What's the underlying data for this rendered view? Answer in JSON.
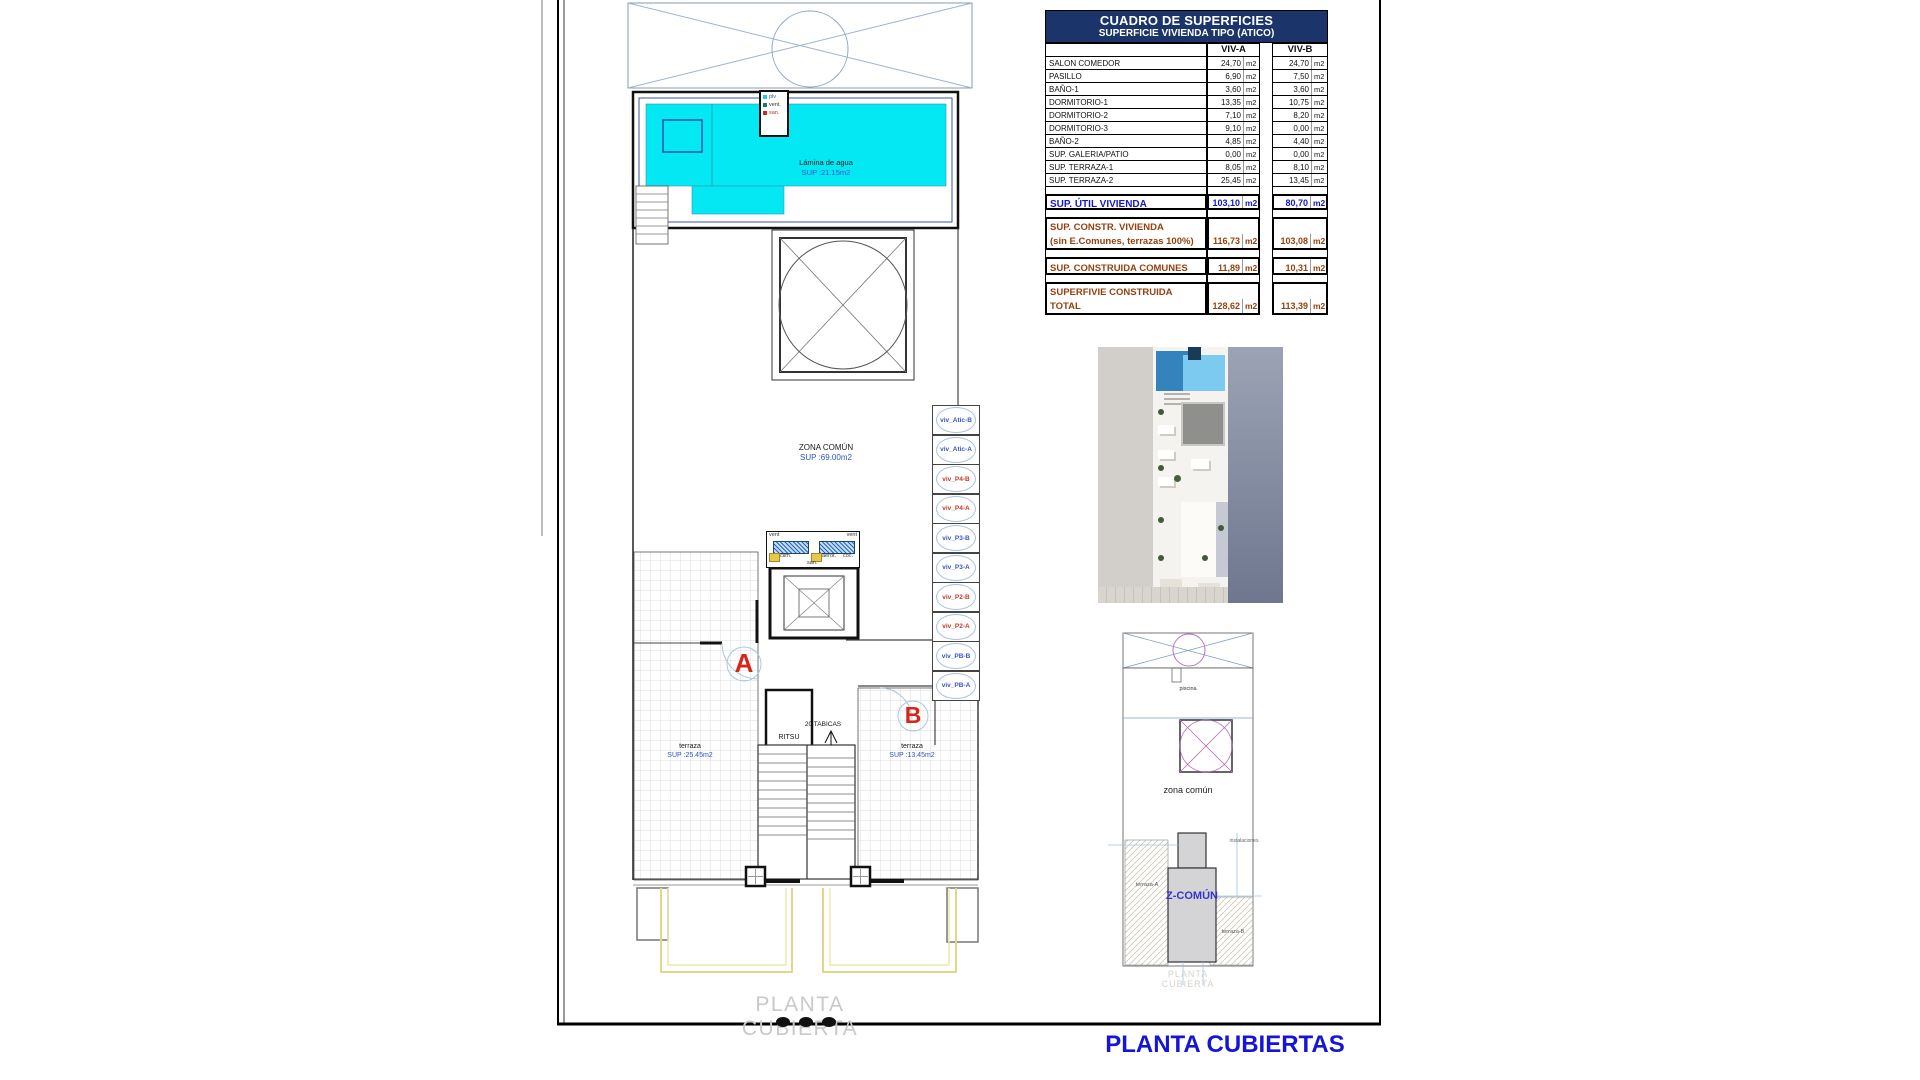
{
  "frame": {
    "sheet_caption": "PLANTA CUBIERTA",
    "title": "PLANTA CUBIERTAS"
  },
  "table": {
    "title": "CUADRO DE SUPERFICIES",
    "subtitle": "SUPERFICIE VIVIENDA TIPO  (ATICO)",
    "col_a": "VIV-A",
    "col_b": "VIV-B",
    "unit": "m2",
    "rows": [
      {
        "label": "SALON COMEDOR",
        "a": "24,70",
        "b": "24,70"
      },
      {
        "label": "PASILLO",
        "a": "6,90",
        "b": "7,50"
      },
      {
        "label": "BAÑO-1",
        "a": "3,60",
        "b": "3,60"
      },
      {
        "label": "DORMITORIO-1",
        "a": "13,35",
        "b": "10,75"
      },
      {
        "label": "DORMITORIO-2",
        "a": "7,10",
        "b": "8,20"
      },
      {
        "label": "DORMITORIO-3",
        "a": "9,10",
        "b": "0,00"
      },
      {
        "label": "BAÑO-2",
        "a": "4,85",
        "b": "4,40"
      },
      {
        "label": "SUP. GALERIA/PATIO",
        "a": "0,00",
        "b": "0,00"
      },
      {
        "label": "SUP. TERRAZA-1",
        "a": "8,05",
        "b": "8,10"
      },
      {
        "label": "SUP. TERRAZA-2",
        "a": "25,45",
        "b": "13,45"
      }
    ],
    "summary": [
      {
        "label": "SUP. ÚTIL VIVIENDA",
        "label2": "",
        "a": "103,10",
        "b": "80,70"
      },
      {
        "label": "SUP. CONSTR. VIVIENDA",
        "label2": "(sin E.Comunes, terrazas 100%)",
        "a": "116,73",
        "b": "103,08"
      },
      {
        "label": "SUP. CONSTRUIDA COMUNES",
        "label2": "",
        "a": "11,89",
        "b": "10,31"
      },
      {
        "label": "SUPERFIVIE CONSTRUIDA",
        "label2": "TOTAL",
        "a": "128,62",
        "b": "113,39"
      }
    ]
  },
  "plan": {
    "pool": {
      "name": "Lámina de agua",
      "area": "SUP :21.15m2"
    },
    "pool_legend": [
      {
        "label": "plv",
        "color": "#28c8e0",
        "text_color": "#2a55c8"
      },
      {
        "label": "vent.",
        "color": "#1b7a70",
        "text_color": "#333333"
      },
      {
        "label": "san.",
        "color": "#c03028",
        "text_color": "#c03028"
      }
    ],
    "zona_comun": {
      "name": "ZONA COMÚN",
      "area": "SUP :69.00m2"
    },
    "machine": {
      "vent_left": "vent",
      "vent_right": "vent",
      "clim": "clim.",
      "aerot": "aerot.",
      "coc": "coc.",
      "san": "san."
    },
    "stairs": {
      "tabicas": "20 TABICAS",
      "ritsu": "RITSU"
    },
    "markers": {
      "a": "A",
      "b": "B"
    },
    "terraza_a": {
      "name": "terraza",
      "area": "SUP :25.45m2"
    },
    "terraza_b": {
      "name": "terraza",
      "area": "SUP :13.45m2"
    },
    "vents": [
      {
        "label": "viv_Atic-B",
        "color": "blue"
      },
      {
        "label": "viv_Atic-A",
        "color": "blue"
      },
      {
        "label": "viv_P4-B",
        "color": "red"
      },
      {
        "label": "viv_P4-A",
        "color": "red"
      },
      {
        "label": "viv_P3-B",
        "color": "blue"
      },
      {
        "label": "viv_P3-A",
        "color": "blue"
      },
      {
        "label": "viv_P2-B",
        "color": "red"
      },
      {
        "label": "viv_P2-A",
        "color": "red"
      },
      {
        "label": "viv_PB-B",
        "color": "blue"
      },
      {
        "label": "viv_PB-A",
        "color": "blue"
      }
    ]
  },
  "siteplan": {
    "piscina": "piscina",
    "zona_comun": "zona común",
    "z_comun": "Z-COMÚN",
    "instalaciones": "instalaciones",
    "terraza_a": "terraza-A",
    "terraza_b": "terraza-B",
    "caption": "PLANTA CUBIERTA"
  },
  "colors": {
    "title_blue": "#1515d8",
    "table_header_bg": "#1b3469",
    "summary_blue": "#1617c9",
    "summary_brown": "#95410f",
    "pool_cyan": "#04e8f4",
    "marker_red": "#d3271b",
    "vent_blue": "#3a55c8",
    "vent_red": "#c2382a"
  }
}
